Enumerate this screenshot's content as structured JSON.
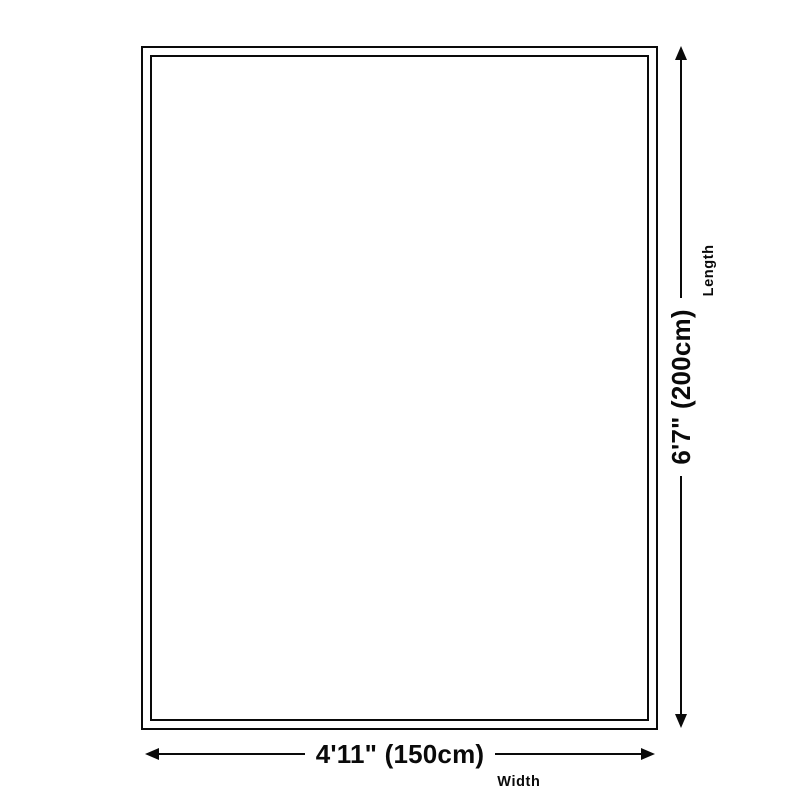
{
  "diagram": {
    "type": "product-dimension-diagram",
    "subject": "rug-outline"
  },
  "dimensions": {
    "width": {
      "value": "4'11\" (150cm)",
      "label": "Width"
    },
    "length": {
      "value": "6'7\" (200cm)",
      "label": "Length"
    }
  },
  "theme": {
    "line_color": "#0a0a0a",
    "background": "#ffffff"
  }
}
